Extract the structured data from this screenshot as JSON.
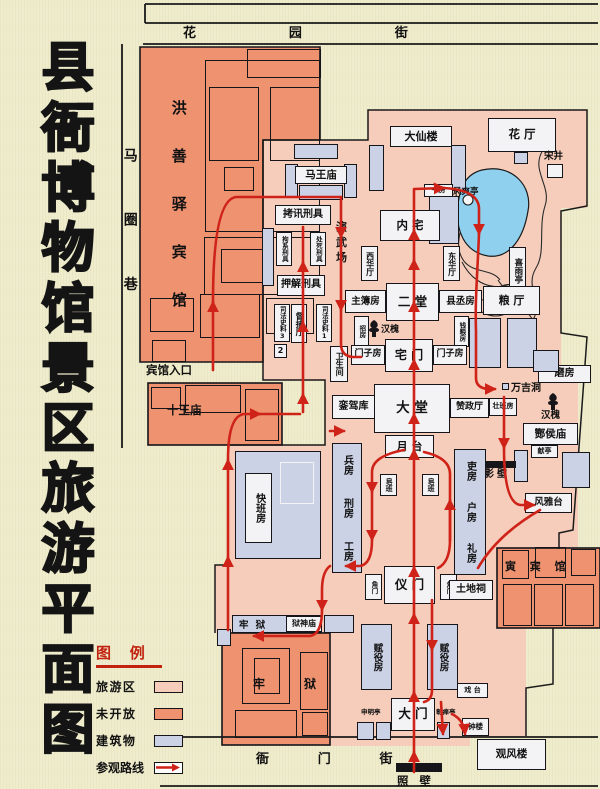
{
  "title": "县衙博物馆景区旅游平面图",
  "streets": {
    "top": "花 园 街",
    "left": "马圈巷",
    "bottom": "衙 门 街"
  },
  "legend": {
    "title": "图 例",
    "items": [
      {
        "label": "旅游区",
        "color": "#f6cdba"
      },
      {
        "label": "未开放",
        "color": "#ee9270"
      },
      {
        "label": "建筑物",
        "color": "#cbd2e6"
      },
      {
        "label": "参观路线",
        "color": "#ffffff"
      }
    ]
  },
  "colors": {
    "tourist": "#f6cdba",
    "closed": "#ee9270",
    "building": "#cbd2e6",
    "route": "#cf2218",
    "pond": "#8fd0ee",
    "background": "#efeccb"
  },
  "labels": {
    "hotel": "洪善驿宾馆",
    "hotel_entrance": "宾馆入口",
    "shiwangmiao": "十王庙",
    "mawangmiao": "马王庙",
    "daxianlou": "大仙楼",
    "huating": "花  厅",
    "songjing": "宋井",
    "shufang": "书房",
    "pond_pavilion": "风爽亭",
    "xiyuting": "喜雨亭",
    "neizhai": "内  宅",
    "xihuating": "西华厅",
    "donghuating": "东华厅",
    "kaoxun": "拷讯刑具",
    "yanwuchang": "演武场",
    "juxi": "拘系刑具",
    "chusi": "处死刑具",
    "yajie": "押解刑具",
    "sifa3": "司法史料3",
    "sifa2": "2",
    "dubuting": "督捕厅",
    "sifa1": "司法史料1",
    "zhubufang": "主簿房",
    "ertang": "二  堂",
    "xianchengfang": "县丞房",
    "zhaofang": "招房",
    "hanhuai": "汉槐",
    "qianliangfang": "钱粮房",
    "menzifang": "门子房",
    "zhaimen": "宅  门",
    "weishengjian": "卫生间",
    "luanjiaku": "銮驾库",
    "datang": "大    堂",
    "zanzhengting": "赞政厅",
    "zhuangbanfang": "壮班房",
    "yuetai": "月 台",
    "wanjidong": "万吉洞",
    "zanhoumiao": "酂侯庙",
    "xianting": "献亭",
    "mofang": "磨房",
    "liangting": "粮  厅",
    "yingbi": "影壁",
    "fengyatai": "风雅台",
    "bingfang": "兵房",
    "xingfang": "刑房",
    "gongfang": "工房",
    "lifang": "吏房",
    "hufang": "户房",
    "lifang2": "礼房",
    "zaoban": "皂班",
    "kuaibanfang": "快班房",
    "yimen": "仪  门",
    "jiaomen": "角门",
    "tudici": "土地祠",
    "yinbinguan": "寅 宾 馆",
    "fuyifang": "赋役房",
    "shenmingting": "申明亭",
    "damen": "大 门",
    "zhangdanting": "彰瘅亭",
    "xitai": "戏 台",
    "zhonglou": "钟楼",
    "guanfenglou": "观风楼",
    "zhaobi": "照 壁",
    "laoyu": "牢  狱",
    "yushenmiao": "狱神庙",
    "lao": "牢",
    "yu": "狱"
  }
}
